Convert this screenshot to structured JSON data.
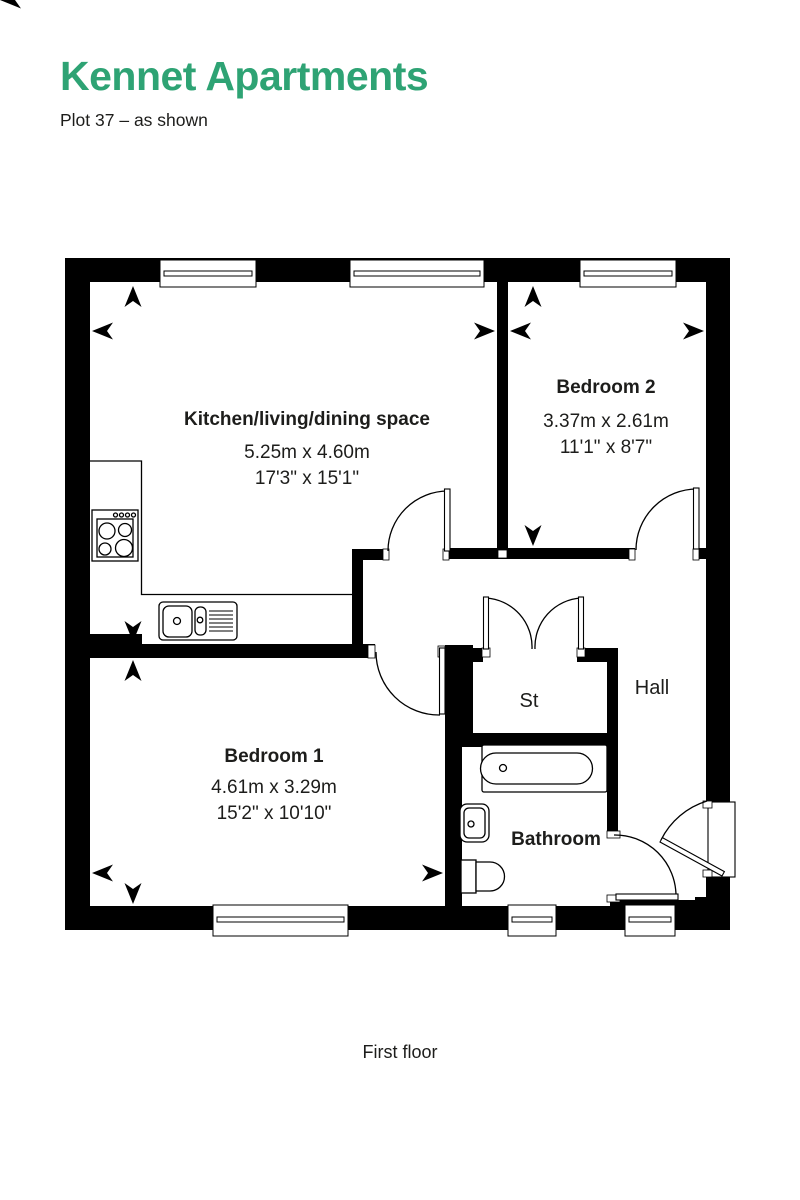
{
  "header": {
    "title": "Kennet Apartments",
    "subtitle": "Plot 37 – as shown"
  },
  "plan": {
    "floor_label": "First floor",
    "rooms": {
      "kitchen": {
        "name": "Kitchen/living/dining space",
        "metric": "5.25m x 4.60m",
        "imperial": "17'3\" x 15'1\""
      },
      "bedroom2": {
        "name": "Bedroom 2",
        "metric": "3.37m x 2.61m",
        "imperial": "11'1\" x 8'7\""
      },
      "bedroom1": {
        "name": "Bedroom 1",
        "metric": "4.61m x 3.29m",
        "imperial": "15'2\" x 10'10\""
      },
      "storage": {
        "name": "St"
      },
      "hall": {
        "name": "Hall"
      },
      "bathroom": {
        "name": "Bathroom"
      }
    }
  },
  "colors": {
    "accent": "#2ea374",
    "ink": "#1d1d1b",
    "walls": "#000000"
  }
}
